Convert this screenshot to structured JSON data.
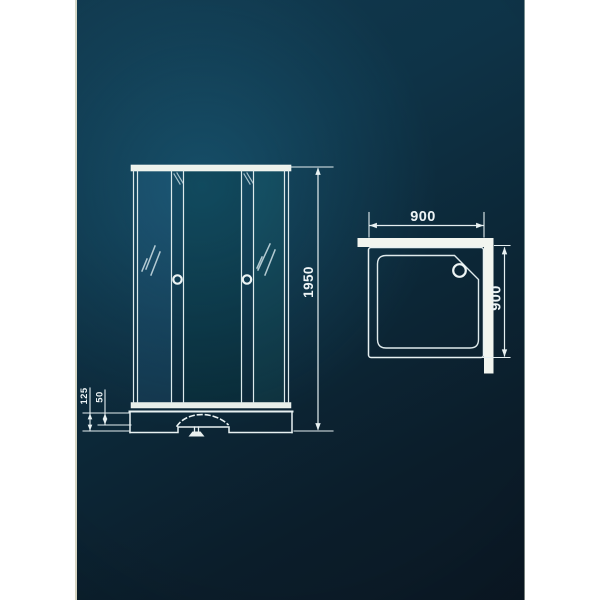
{
  "diagram": {
    "front_view": {
      "height_dim": "1950",
      "tray_height_dim": "125",
      "tray_rim_dim": "50"
    },
    "top_view": {
      "width_dim": "900",
      "depth_dim": "900"
    },
    "colors": {
      "background_teal": "#0e3347",
      "background_dark": "#0b1824",
      "line_white": "#e8f1f2",
      "profile_white": "#f2f5ef",
      "margin_white": "#ffffff"
    },
    "icons": {
      "door_handle": "circle-knob",
      "glass_shine": "diagonal-strokes",
      "drain_waste": "siphon-trap",
      "tray_drain": "circle"
    }
  }
}
